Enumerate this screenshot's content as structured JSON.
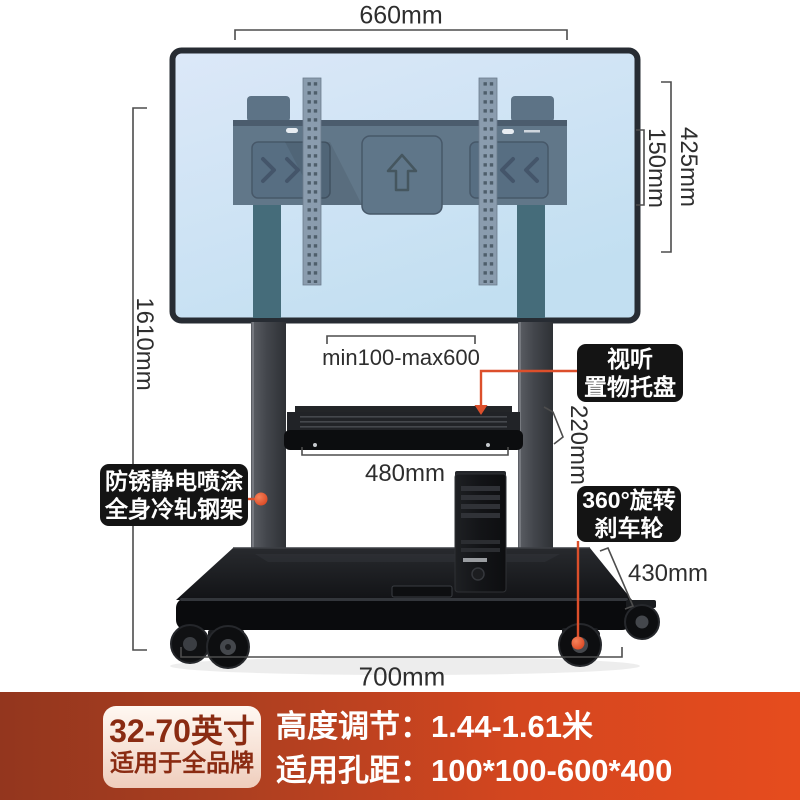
{
  "dimensions": {
    "top_width": "660mm",
    "plate_height": "425mm",
    "plate_inner_height": "150mm",
    "total_height": "1610mm",
    "vesa_width_range": "min100-max600",
    "tray_drop": "220mm",
    "tray_width": "480mm",
    "base_depth": "430mm",
    "base_width": "700mm"
  },
  "callouts": {
    "tray": {
      "line1": "视听",
      "line2": "置物托盘"
    },
    "frame": {
      "line1": "防锈静电喷涂",
      "line2": "全身冷轧钢架"
    },
    "wheels": {
      "line1": "360°旋转",
      "line2": "刹车轮"
    }
  },
  "banner": {
    "size_range": "32-70英寸",
    "brand_fit": "适用于全品牌",
    "height_adjustment": "高度调节：1.44-1.61米",
    "vesa_pitch": "适用孔距：100*100-600*400"
  },
  "colors": {
    "accent_red": "#dc4f2b",
    "banner_left": "#93361e",
    "banner_right": "#e64c1e",
    "callout_bg": "#141414"
  }
}
